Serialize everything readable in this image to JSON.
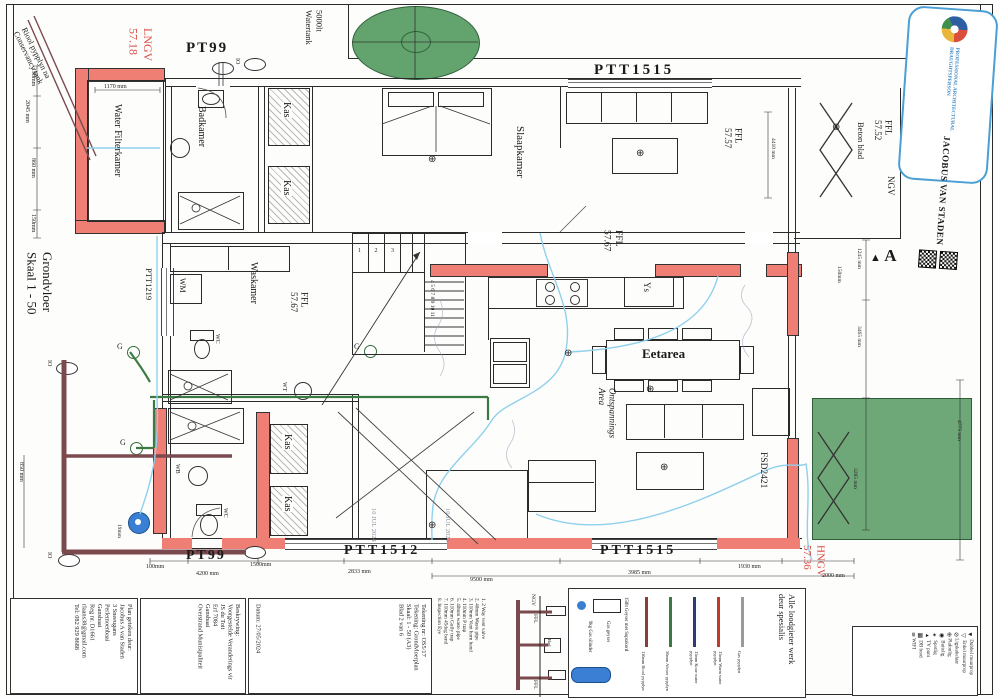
{
  "colors": {
    "wall_red": "#ef7e74",
    "sewer_maroon": "#7b4a4f",
    "waste_green": "#3b7a43",
    "cold_blue": "#8fd0ec",
    "tank_green": "#63a46e",
    "patio_green": "#6fa878",
    "red_text": "#d84b44",
    "stamp_blue": "#4a9fd4",
    "cylinder_blue": "#3b7fd4"
  },
  "labels": {
    "grondvloer": [
      "Grondvloer",
      "Skaal 1 - 50"
    ],
    "lngv": [
      "LNGV",
      "57.18"
    ],
    "hngv": [
      "HNGV",
      "57.36"
    ],
    "ffl_sit": [
      "FFL",
      "57.57"
    ],
    "ffl_stoep": [
      "FFL",
      "57.52"
    ],
    "ffl_67": [
      "FFL",
      "57.67"
    ],
    "beton": "Beton blad",
    "ngv": "NGV",
    "section_a": "A",
    "pt99_top": "PT99",
    "ptt1515_top": "PTT1515",
    "ptt1219": "PTT1219",
    "pt99_bot": "PT99",
    "ptt1512": "PTT1512",
    "ptt1515_bot": "PTT1515",
    "fsd": "FSD2421"
  },
  "yard": {
    "tank_label": [
      "5000lt",
      "Watertank"
    ],
    "sewer_note": [
      "Riool pypplyn na",
      "Conservancy tank"
    ]
  },
  "rooms": {
    "wfk": "Water Filterkamer",
    "bad": "Badkamer",
    "slaap": "Slaapkamer",
    "was": "Waskamer",
    "eet": "Eetarea",
    "lounge": [
      "Ontspannings",
      "Area"
    ],
    "kas": "Kas"
  },
  "fix": {
    "wm": "WM",
    "wc": "WC",
    "wb": "WB",
    "wt": "WT",
    "ys": "Ys",
    "g": "G",
    "io": "IO",
    "d19": "19mm"
  },
  "stairs": {
    "low": "1   2   3",
    "high": "4 5 6 7 8 9 10 11"
  },
  "dims": {
    "left": [
      "190mm",
      "2045 mm",
      "860 mm",
      "150mm",
      "850 mm"
    ],
    "top_wfk": "1170 mm",
    "bottom": [
      "100mm",
      "4200 mm",
      "1500mm",
      "2833 mm",
      "9500 mm",
      "3985 mm",
      "1930 mm",
      "2000 mm"
    ],
    "right": [
      "150mm",
      "1245 mm",
      "3465 mm",
      "3285 mm",
      "4775 mm"
    ],
    "sit": "4410 mm"
  },
  "approval_stamp": "10 JUL 2024",
  "stamp": {
    "org1": "PROFESSIONAL ARCHITECTURAL",
    "org2": "DRAUGHTSPERSON",
    "name": "JACOBUS VAN STADEN"
  },
  "tb": {
    "author": [
      "Plan geteken deur:",
      "Jacobus A van Staden",
      "3 Sneeugans",
      "Perlemoenbaai",
      "Gansbaai",
      "Reg nr. D1661",
      "rlaans38@gmail.com",
      "Tel: 082 929 8688"
    ],
    "desc": [
      "Beskrywing:",
      "Voorgestelde Veranderings vir",
      "JS du Toit",
      "Erf 7084",
      "Gansbaai",
      "Overstrand Munisipaliteit"
    ],
    "draw": [
      "Tekening nr:  OS5/17",
      "Tekening: Grondvloerplan",
      "Skaal: 1 - 50 (A3)",
      "Blad 2 van 6"
    ],
    "datum": "Datum: 27/05/2024"
  },
  "detail": {
    "items": [
      "1. 2 Way vent valve",
      "2. 40mm Waste pipe",
      "3. 110mm Vent horn bend",
      "4. 110mm P trap",
      "5. 40mm waste pipe",
      "6. 110mm Gully trap",
      "7. 110mm 45deg bend",
      "8. Inspection Eye"
    ],
    "ngv": "NGV",
    "ffl": "FFL",
    "bad": "Bad"
  },
  "plumb": {
    "title": [
      "Alle loodgieter werk",
      "deur spesialis"
    ],
    "lines": [
      {
        "label": "Gas pypplyn",
        "color": "#9a9a9a"
      },
      {
        "label": "15mm Warm water pypplyn",
        "color": "#c0392b"
      },
      {
        "label": "15mm Koue water pypplyn",
        "color": "#2c3e70"
      },
      {
        "label": "50mm Afvoer pypplyn",
        "color": "#3b7a43"
      },
      {
        "label": "110mm Riool pypplyn",
        "color": "#8e3b3b"
      }
    ],
    "geyser": "150lt Geyser met Suprakord",
    "gas_geyser": "Gas geyser",
    "cyl": "9kg Gas silinder"
  },
  "elec": {
    "items": [
      {
        "s": "◄",
        "l": "Dubbel muurprop"
      },
      {
        "s": "◁",
        "l": "Enkel muurprop"
      },
      {
        "s": "⊘",
        "l": "Ligskakelaar"
      },
      {
        "s": "⊕",
        "l": "Plafonlig"
      },
      {
        "s": "◉",
        "l": "Buitelig"
      },
      {
        "s": "✶",
        "l": "Spotlig"
      },
      {
        "s": "▸",
        "l": "TV punt"
      },
      {
        "s": "▦",
        "l": "DB bord"
      },
      {
        "s": "≋",
        "l": "WIFI"
      }
    ]
  },
  "glyphs": {
    "light": "⊕",
    "tri": "▲"
  }
}
